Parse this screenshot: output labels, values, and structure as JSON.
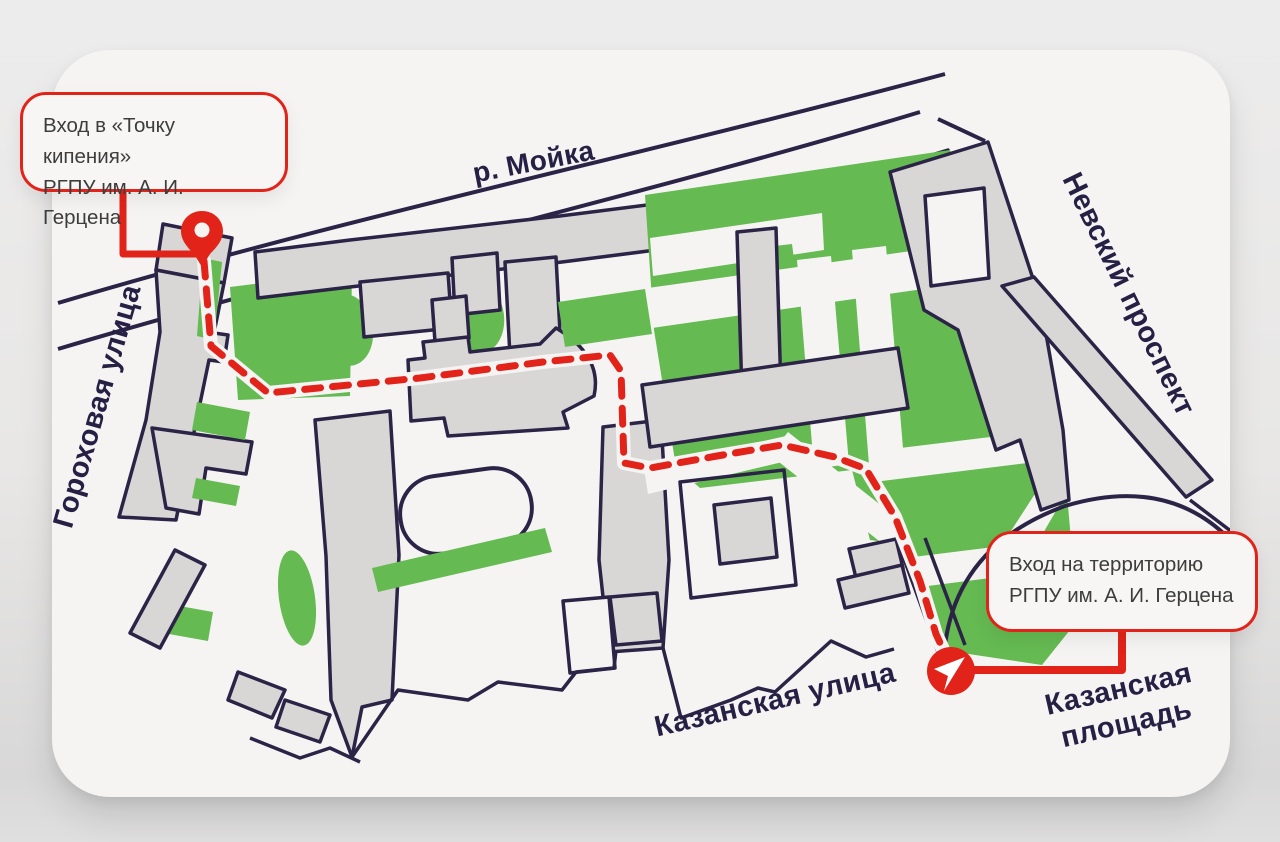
{
  "map": {
    "river_label": "р. Мойка",
    "streets": {
      "gorokhovaya": "Гороховая улица",
      "nevsky": "Невский проспект",
      "kazanskaya_street": "Казанская улица",
      "kazanskaya_square": "Казанская площадь"
    },
    "callouts": {
      "boiling_point": {
        "line1": "Вход в «Точку кипения»",
        "line2": "РГПУ им. А. И. Герцена"
      },
      "territory_entrance": {
        "line1": "Вход на территорию",
        "line2": "РГПУ им. А. И. Герцена"
      }
    },
    "markers": {
      "start": "map-pin-icon",
      "destination": "navigation-arrow-icon"
    },
    "colors": {
      "route_red": "#E2231A",
      "outline_navy": "#2B2446",
      "green_area": "#65BA52",
      "building_gray": "#D8D7D6",
      "card_white": "#F5F4F3",
      "page_gray": "#E8E7E6"
    }
  }
}
